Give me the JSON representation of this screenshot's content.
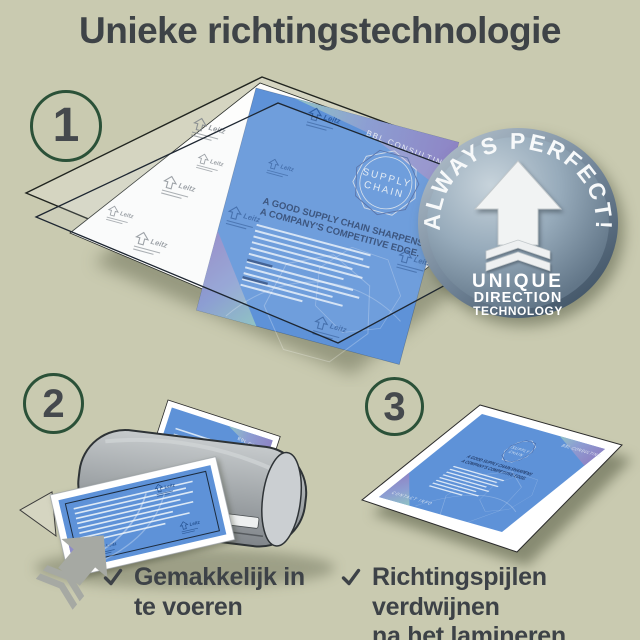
{
  "title": "Unieke richtingstechnologie",
  "steps": [
    {
      "number": "1"
    },
    {
      "number": "2"
    },
    {
      "number": "3"
    }
  ],
  "badge": {
    "arc_text": "ALWAYS PERFECT!",
    "lines": [
      "UNIQUE",
      "DIRECTION",
      "TECHNOLOGY"
    ],
    "arrow_icon": "up-arrow-with-chevrons"
  },
  "flyer": {
    "brand": "BBL CONSULTING",
    "emblem": {
      "line1": "SUPPLY",
      "line2": "CHAIN"
    },
    "headline_line1": "A GOOD SUPPLY CHAIN SHARPENS",
    "headline_line2": "A COMPANY'S COMPETITIVE EDGE.",
    "footer": "CONTACT INFO",
    "page_color": "#5e92d8"
  },
  "pouch": {
    "brand": "Leitz",
    "mark_icon": "direction-arrow"
  },
  "checklist": [
    {
      "icon": "checkmark",
      "line1": "Gemakkelijk in",
      "line2": "te voeren"
    },
    {
      "icon": "checkmark",
      "line1": "Richtingspijlen verdwijnen",
      "line2": "na het lamineren"
    }
  ],
  "colors": {
    "background": "#c9cab0",
    "text": "#3d4247",
    "step_circle_green": "#2b5138",
    "badge_face": "#8fa5b6",
    "laminator_gray": "#9aa0a3"
  }
}
